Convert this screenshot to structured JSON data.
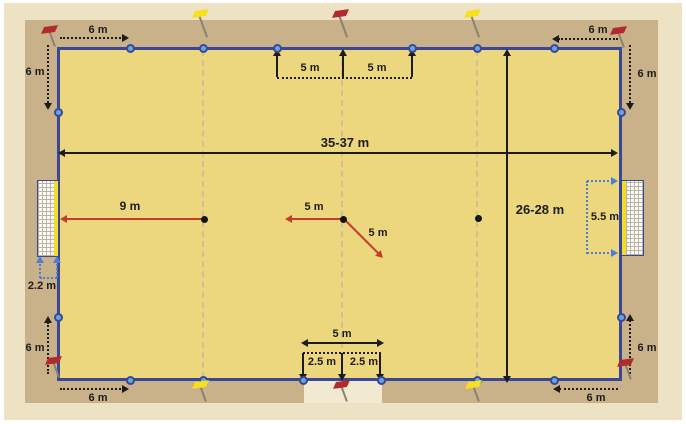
{
  "field": {
    "length_label": "35-37 m",
    "width_label": "26-28 m"
  },
  "corners": {
    "top_left_horizontal": "6 m",
    "top_left_vertical": "6 m",
    "top_right_horizontal": "6 m",
    "top_right_vertical": "6 m",
    "bottom_left_horizontal": "6 m",
    "bottom_left_vertical": "6 m",
    "bottom_right_horizontal": "6 m",
    "bottom_right_vertical": "6 m"
  },
  "top_markers": {
    "left_5m": "5 m",
    "right_5m": "5 m"
  },
  "center": {
    "penalty_label": "9 m",
    "left_label": "5 m",
    "diagonal_label": "5 m"
  },
  "goals": {
    "width_label": "5.5 m",
    "depth_label": "2.2 m"
  },
  "substitution_zone": {
    "total_label": "5 m",
    "left_half_label": "2.5 m",
    "right_half_label": "2.5 m"
  },
  "icons": [
    "corner-flag-icon",
    "halfway-flag-icon",
    "quarter-flag-icon",
    "goal-net",
    "boundary-marker",
    "penalty-spot"
  ],
  "colors": {
    "background": "#EDE2C4",
    "sand": "#C9B28A",
    "field": "#ECD77E",
    "boundary": "#3A4796",
    "marker": "#64A7DE",
    "flag_red": "#B02A2E",
    "flag_yellow": "#F6E01F",
    "dimension_black": "#1C1C1C",
    "dimension_red": "#C63B2B",
    "dimension_blue": "#4A7FD4",
    "goal_frame": "#F3DD28",
    "substitution_zone": "#F2EAD0",
    "center_dash": "#D0C093"
  }
}
